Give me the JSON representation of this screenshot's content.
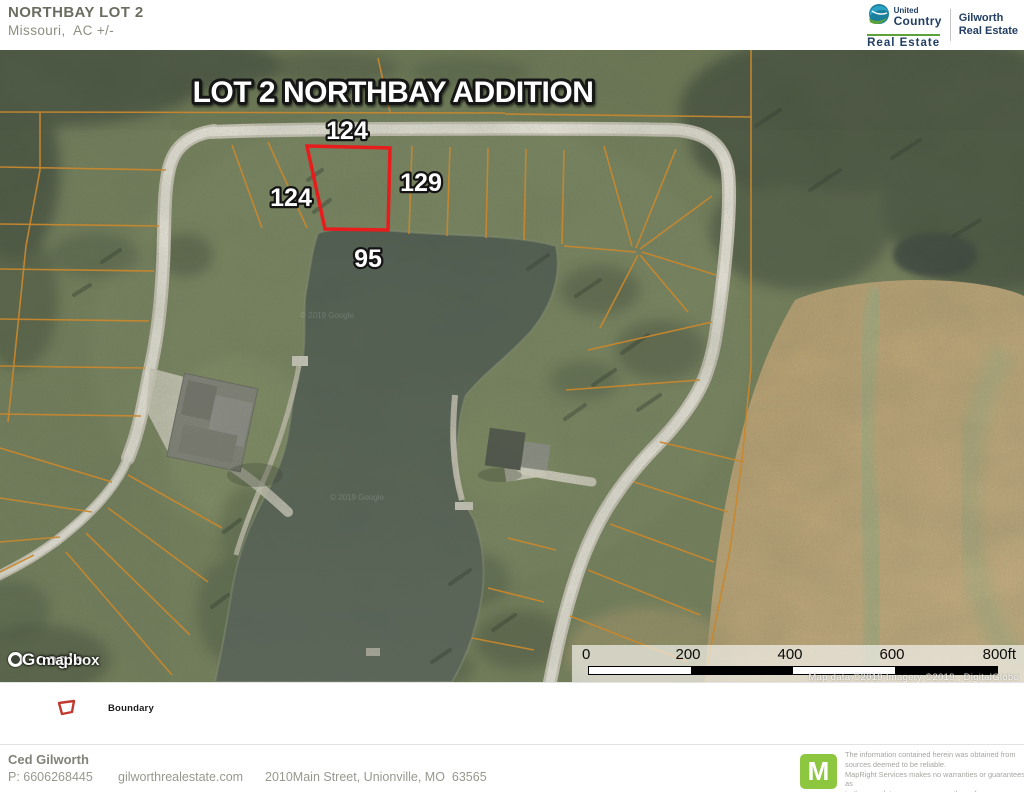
{
  "header": {
    "title": "NORTHBAY LOT 2",
    "subtitle": "Missouri,  AC +/-"
  },
  "brand": {
    "uc_name_top": "United",
    "uc_name_bottom": "Country",
    "uc_sub": "Real Estate",
    "right_line1": "Gilworth",
    "right_line2": "Real Estate"
  },
  "map": {
    "title": "LOT 2 NORTHBAY ADDITION",
    "boundary_lengths": {
      "top": "124",
      "left": "124",
      "right": "129",
      "bottom": "95"
    },
    "watermark_google": "Google",
    "watermark_mapbox": "mapbox",
    "watermark_faint": "© 2019 Google",
    "scale": {
      "labels": [
        "0",
        "200",
        "400",
        "600",
        "800ft"
      ]
    },
    "attribution": "Map data ©2019  Imagery ©2019 , DigitalGlobe"
  },
  "legend": {
    "boundary_label": "Boundary"
  },
  "footer": {
    "name": "Ced Gilworth",
    "phone": "P: 6606268445",
    "website": "gilworthrealestate.com",
    "address": "2010Main Street, Unionville, MO  63565",
    "mapright_letter": "M",
    "disclaimer1": "The information contained herein was obtained from",
    "disclaimer2": "sources deemed to be reliable.",
    "disclaimer3": "  MapRight Services makes no warranties or guarantees as",
    "disclaimer4": "to the completeness or accuracy thereof."
  },
  "colors": {
    "boundary_red": "#e81c1c",
    "lot_line_orange": "#c8872e",
    "mapright_green": "#8dc63f",
    "brand_navy": "#223f63"
  }
}
